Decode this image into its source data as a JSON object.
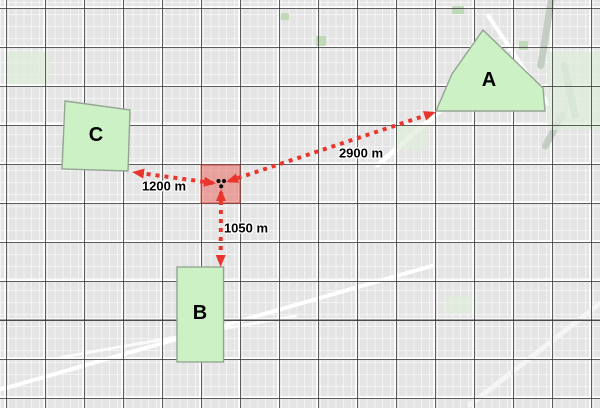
{
  "map": {
    "zones": [
      {
        "label": "A"
      },
      {
        "label": "B"
      },
      {
        "label": "C"
      }
    ],
    "incident_area": {
      "shape": "red-square",
      "marker_icon": "hazard-marker-icon"
    },
    "measurements": [
      {
        "to_zone": "A",
        "label": "2900 m"
      },
      {
        "to_zone": "B",
        "label": "1050 m"
      },
      {
        "to_zone": "C",
        "label": "1200 m"
      }
    ],
    "colors": {
      "zone_fill": "#cbf1c4",
      "zone_border": "#94a594",
      "incident_fill": "rgba(232,80,72,0.45)",
      "incident_border": "rgba(200,45,40,0.75)",
      "arrow_red": "#ea352c",
      "grid_line": "#323232",
      "map_base": "#e4e4e4"
    }
  }
}
